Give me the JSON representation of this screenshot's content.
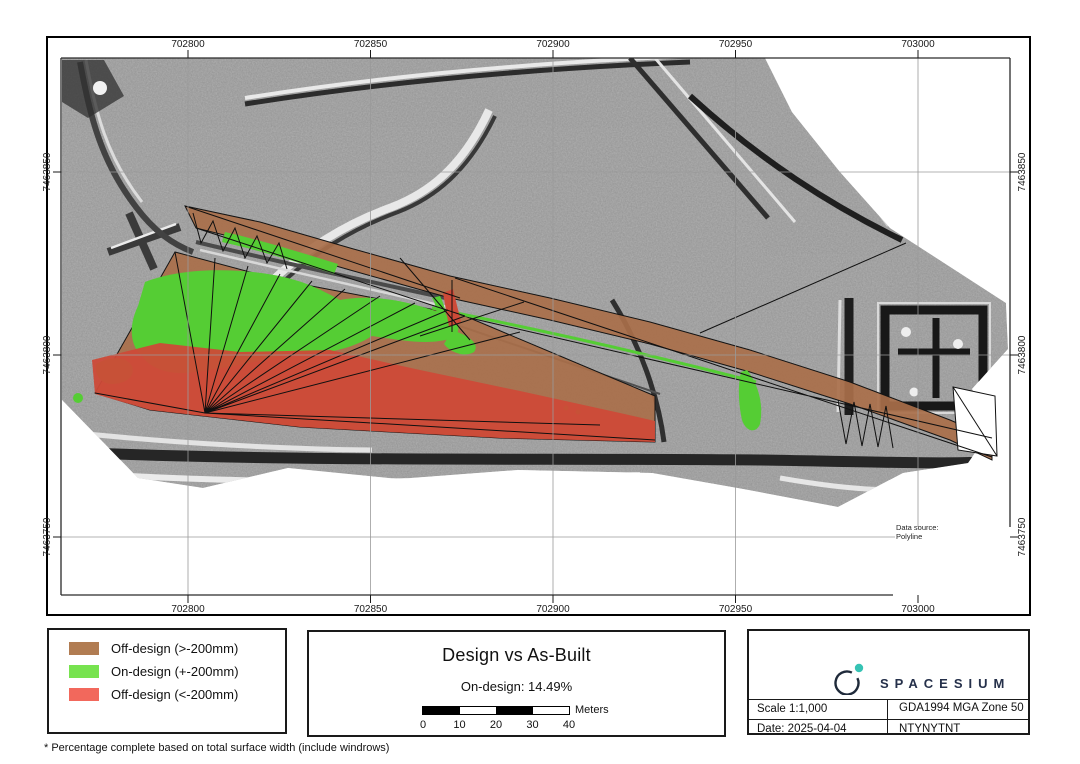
{
  "map": {
    "grid": {
      "x_labels": [
        "702800",
        "702850",
        "702900",
        "702950",
        "703000"
      ],
      "y_labels": [
        "7463850",
        "7463800",
        "7463750"
      ]
    },
    "annotation": {
      "line1": "Data source:",
      "line2": "Polyline"
    },
    "colors": {
      "terrain": "#9b9b9b",
      "off_high": "#a96f4a",
      "on_design": "#55cd34",
      "off_low": "#cd4a38"
    }
  },
  "legend": {
    "items": [
      {
        "label": "Off-design (>-200mm)",
        "color": "#b17c52"
      },
      {
        "label": "On-design (+-200mm)",
        "color": "#77e34f"
      },
      {
        "label": "Off-design (<-200mm)",
        "color": "#f2685c"
      }
    ]
  },
  "title_panel": {
    "title": "Design vs As-Built",
    "subtitle": "On-design: 14.49%",
    "scalebar": {
      "ticks": [
        "0",
        "10",
        "20",
        "30",
        "40"
      ],
      "unit": "Meters"
    }
  },
  "info_panel": {
    "brand": "SPACESIUM",
    "scale": "Scale 1:1,000",
    "crs": "GDA1994 MGA Zone 50",
    "date": "Date: 2025-04-04",
    "code": "NTYNYTNT"
  },
  "footer": {
    "note": "* Percentage complete based on total surface width (include windrows)"
  }
}
